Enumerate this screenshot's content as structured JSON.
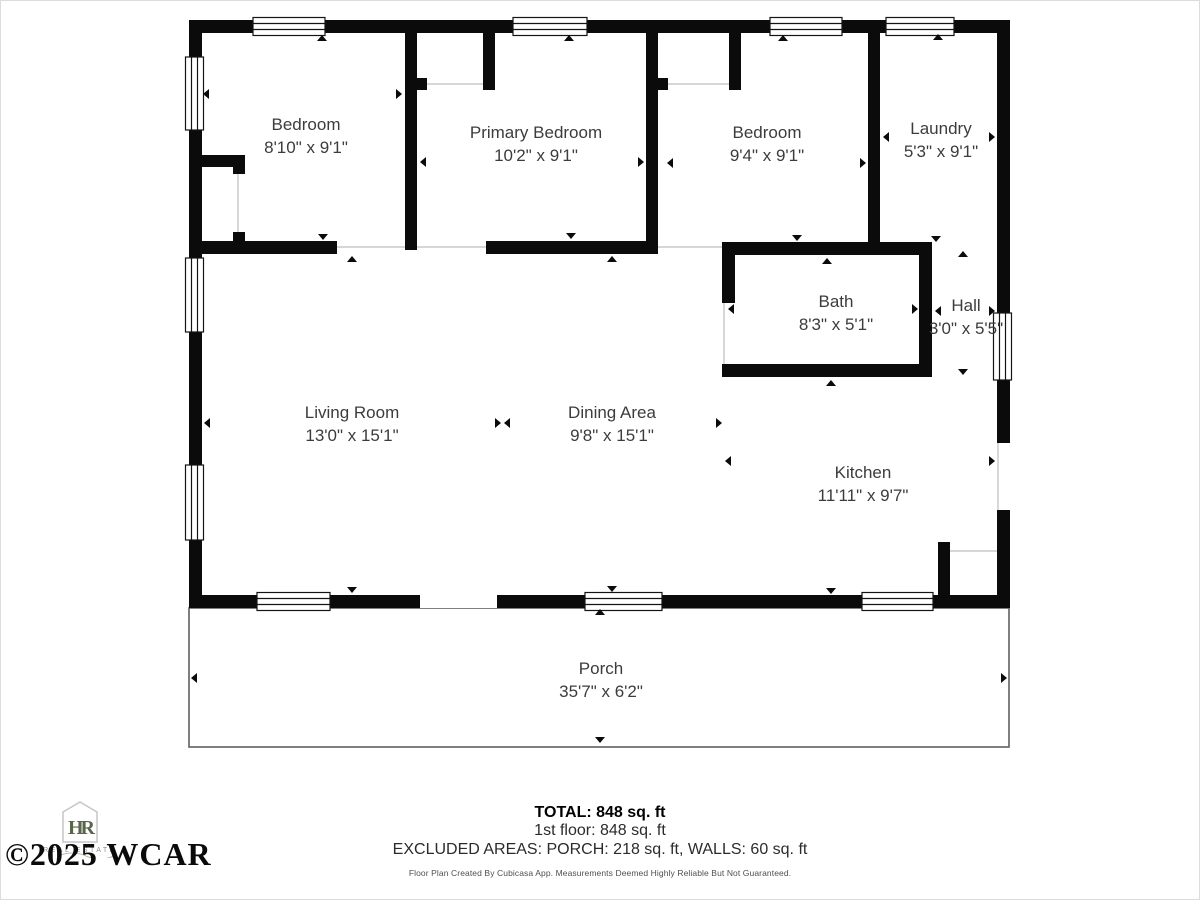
{
  "plan": {
    "rooms": [
      {
        "id": "bedroom-1",
        "name": "Bedroom",
        "dims": "8'10\" x 9'1\""
      },
      {
        "id": "primary-bedroom",
        "name": "Primary Bedroom",
        "dims": "10'2\" x 9'1\""
      },
      {
        "id": "bedroom-2",
        "name": "Bedroom",
        "dims": "9'4\" x 9'1\""
      },
      {
        "id": "laundry",
        "name": "Laundry",
        "dims": "5'3\" x 9'1\""
      },
      {
        "id": "bath",
        "name": "Bath",
        "dims": "8'3\" x 5'1\""
      },
      {
        "id": "hall",
        "name": "Hall",
        "dims": "3'0\" x 5'5\""
      },
      {
        "id": "living-room",
        "name": "Living Room",
        "dims": "13'0\" x 15'1\""
      },
      {
        "id": "dining-area",
        "name": "Dining Area",
        "dims": "9'8\" x 15'1\""
      },
      {
        "id": "kitchen",
        "name": "Kitchen",
        "dims": "11'11\" x 9'7\""
      },
      {
        "id": "porch",
        "name": "Porch",
        "dims": "35'7\" x 6'2\""
      }
    ]
  },
  "summary": {
    "total": "TOTAL: 848 sq. ft",
    "first_floor": "1st floor: 848 sq. ft",
    "excluded": "EXCLUDED AREAS: PORCH: 218 sq. ft, WALLS: 60 sq. ft",
    "disclaimer": "Floor Plan Created By Cubicasa App. Measurements Deemed Highly Reliable But Not Guaranteed."
  },
  "watermark": {
    "copyright": "©2025 WCAR",
    "monogram": "HR",
    "caption": "REAL ESTATE"
  },
  "colors": {
    "wall": "#0b0b0b",
    "label_text": "#3c3c3c",
    "porch_outline": "#5f5f5f",
    "logo_green": "#5a6649"
  }
}
